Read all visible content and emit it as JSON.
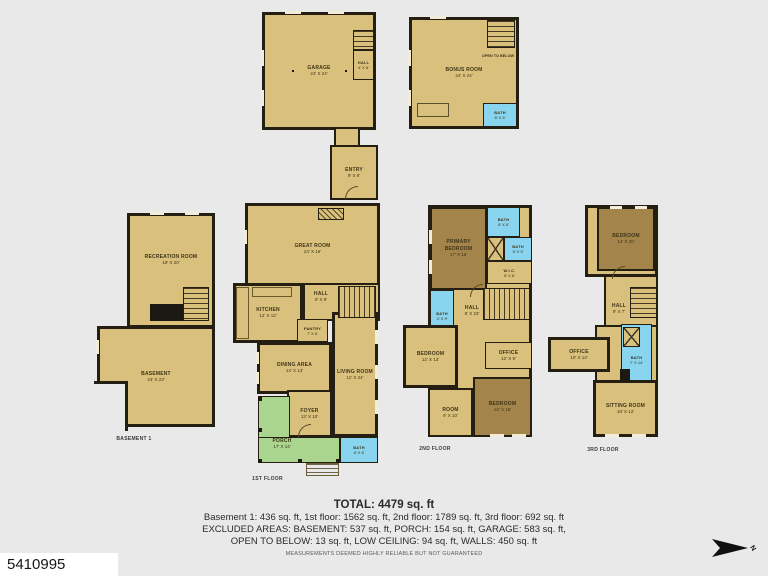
{
  "photo_id": "5410995",
  "compass_label": "N",
  "summary": {
    "total": "TOTAL: 4479 sq. ft",
    "line1": "Basement 1: 436 sq. ft, 1st floor: 1562 sq. ft, 2nd floor: 1789 sq. ft, 3rd floor: 692 sq. ft",
    "line2": "EXCLUDED AREAS: BASEMENT: 537 sq. ft, PORCH: 154 sq. ft, GARAGE: 583 sq. ft,",
    "line3": "OPEN TO BELOW: 13 sq. ft, LOW CEILING: 94 sq. ft, WALLS: 450 sq. ft",
    "disclaimer": "MEASUREMENTS DEEMED HIGHLY RELIABLE BUT NOT GUARANTEED"
  },
  "colors": {
    "background": "#e9e9e9",
    "floor": "#d9c07c",
    "bedroom": "#a3854b",
    "bath": "#89d4ee",
    "porch": "#a9d58e",
    "wall": "#241f12"
  },
  "plans": {
    "garage": {
      "rooms": {
        "garage": {
          "label": "GARAGE",
          "dims": "24' X 24'"
        },
        "hall": {
          "label": "HALL",
          "dims": "4' X 8'"
        }
      }
    },
    "bonus": {
      "rooms": {
        "bonus_room": {
          "label": "BONUS ROOM",
          "dims": "24' X 24'"
        },
        "open_to_below": {
          "label": "OPEN TO BELOW",
          "dims": ""
        },
        "bath": {
          "label": "BATH",
          "dims": "8' X 6'"
        }
      }
    },
    "basement": {
      "caption": "BASEMENT 1",
      "rooms": {
        "recreation_room": {
          "label": "RECREATION ROOM",
          "dims": "19' X 20'"
        },
        "basement": {
          "label": "BASEMENT",
          "dims": "24' X 23'"
        }
      }
    },
    "first_floor": {
      "caption": "1ST FLOOR",
      "rooms": {
        "entry": {
          "label": "ENTRY",
          "dims": "9' X 8'"
        },
        "great_room": {
          "label": "GREAT ROOM",
          "dims": "24' X 16'"
        },
        "hall": {
          "label": "HALL",
          "dims": "9' X 9'"
        },
        "kitchen": {
          "label": "KITCHEN",
          "dims": "12' X 12'"
        },
        "pantry": {
          "label": "PANTRY",
          "dims": "7' X 6'"
        },
        "dining_area": {
          "label": "DINING AREA",
          "dims": "14' X 13'"
        },
        "living_room": {
          "label": "LIVING ROOM",
          "dims": "11' X 24'"
        },
        "foyer": {
          "label": "FOYER",
          "dims": "13' X 10'"
        },
        "porch": {
          "label": "PORCH",
          "dims": "17' X 14'"
        },
        "bath": {
          "label": "BATH",
          "dims": "8' X 6'"
        }
      }
    },
    "second_floor": {
      "caption": "2ND FLOOR",
      "rooms": {
        "primary_bedroom": {
          "label": "PRIMARY BEDROOM",
          "dims": "17' X 15'"
        },
        "bath_top": {
          "label": "BATH",
          "dims": "8' X 6'"
        },
        "bath_mid": {
          "label": "BATH",
          "dims": "8' X 5'"
        },
        "wic": {
          "label": "W.I.C.",
          "dims": "8' X 8'"
        },
        "hall": {
          "label": "HALL",
          "dims": "9' X 23'"
        },
        "bath_left": {
          "label": "BATH",
          "dims": "4' X 9'"
        },
        "bedroom_left": {
          "label": "BEDROOM",
          "dims": "12' X 13'"
        },
        "office": {
          "label": "OFFICE",
          "dims": "12' X 9'"
        },
        "bedroom_right": {
          "label": "BEDROOM",
          "dims": "12' X 15'"
        },
        "room": {
          "label": "ROOM",
          "dims": "9' X 10'"
        }
      }
    },
    "third_floor": {
      "caption": "3RD FLOOR",
      "rooms": {
        "bedroom": {
          "label": "BEDROOM",
          "dims": "14' X 20'"
        },
        "hall": {
          "label": "HALL",
          "dims": "9' X 7'"
        },
        "office": {
          "label": "OFFICE",
          "dims": "10' X 14'"
        },
        "bath": {
          "label": "BATH",
          "dims": "7' X 14'"
        },
        "sitting_room": {
          "label": "SITTING ROOM",
          "dims": "18' X 12'"
        }
      }
    }
  }
}
